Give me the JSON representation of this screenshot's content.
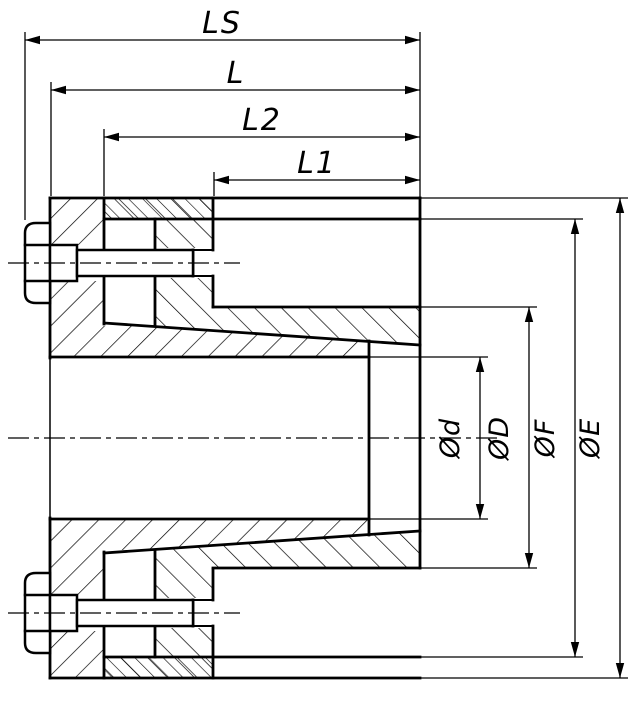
{
  "drawing": {
    "type": "technical-section-drawing",
    "subject": "shaft locking assembly cross-section",
    "colors": {
      "line": "#000000",
      "background": "#ffffff"
    },
    "length_dimensions": [
      {
        "label": "LS"
      },
      {
        "label": "L"
      },
      {
        "label": "L2"
      },
      {
        "label": "L1"
      }
    ],
    "diameter_dimensions": [
      {
        "label": "Ød"
      },
      {
        "label": "ØD"
      },
      {
        "label": "ØF"
      },
      {
        "label": "ØE"
      }
    ]
  }
}
